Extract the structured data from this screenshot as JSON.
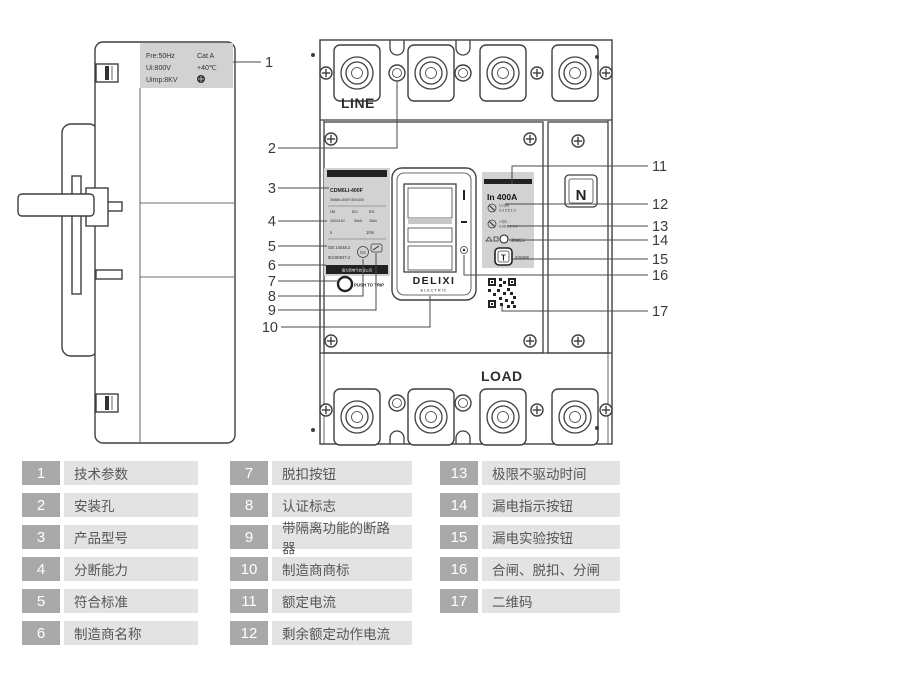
{
  "legend": {
    "items": [
      {
        "num": "1",
        "label": "技术参数"
      },
      {
        "num": "2",
        "label": "安装孔"
      },
      {
        "num": "3",
        "label": "产品型号"
      },
      {
        "num": "4",
        "label": "分断能力"
      },
      {
        "num": "5",
        "label": "符合标准"
      },
      {
        "num": "6",
        "label": "制造商名称"
      },
      {
        "num": "7",
        "label": "脱扣按钮"
      },
      {
        "num": "8",
        "label": "认证标志"
      },
      {
        "num": "9",
        "label": "带隔离功能的断路器"
      },
      {
        "num": "10",
        "label": "制造商商标"
      },
      {
        "num": "11",
        "label": "额定电流"
      },
      {
        "num": "12",
        "label": "剩余额定动作电流"
      },
      {
        "num": "13",
        "label": "极限不驱动时间"
      },
      {
        "num": "14",
        "label": "漏电指示按钮"
      },
      {
        "num": "15",
        "label": "漏电实验按钮"
      },
      {
        "num": "16",
        "label": "合闸、脱扣、分闸"
      },
      {
        "num": "17",
        "label": "二维码"
      }
    ]
  },
  "callouts": [
    "1",
    "2",
    "3",
    "4",
    "5",
    "6",
    "7",
    "8",
    "9",
    "10",
    "11",
    "12",
    "13",
    "14",
    "15",
    "16",
    "17"
  ],
  "diagram": {
    "side_label": {
      "l1a": "Fre:50Hz",
      "l1b": "Cat A",
      "l2a": "Ui:800V",
      "l2b": "+40℃",
      "l3a": "Uimp:8KV"
    },
    "front": {
      "line": "LINE",
      "load": "LOAD",
      "n": "N",
      "brand": "DELIXI",
      "brand_sub": "ELECTRIC",
      "push": "PUSH TO TRIP"
    },
    "product_label": {
      "model": "CDM6LI-400F",
      "code": "3N5ML/400F/300/300",
      "h_ue": "Ue",
      "h_icu": "Icu",
      "h_ics": "Ics",
      "v_ue": "400/415V",
      "v_icu": "50kA",
      "v_ics": "35kA",
      "ii": "Ii",
      "ii_v": "10In",
      "std1": "GB 14048.2",
      "std2": "IEC60947-2",
      "ccc": "CCC",
      "mfr": "德力西电气有限公司"
    },
    "rating_label": {
      "in_value": "In 400A",
      "dial1_l1": "I△n(A)",
      "dial1_l2": "0.3 0.5 1.0",
      "dial2_l1": "△t(s)",
      "dial2_l2": "0.06 0.2 0.4",
      "row3": "漏电指示",
      "t": "T",
      "row4": "实验按钮"
    }
  },
  "colors": {
    "drawing_line": "#3f3f3f",
    "label_fill": "#d2d2d2",
    "legend_num_bg": "#a9a9a9",
    "legend_label_bg": "#e3e3e3",
    "legend_text": "#565656"
  }
}
